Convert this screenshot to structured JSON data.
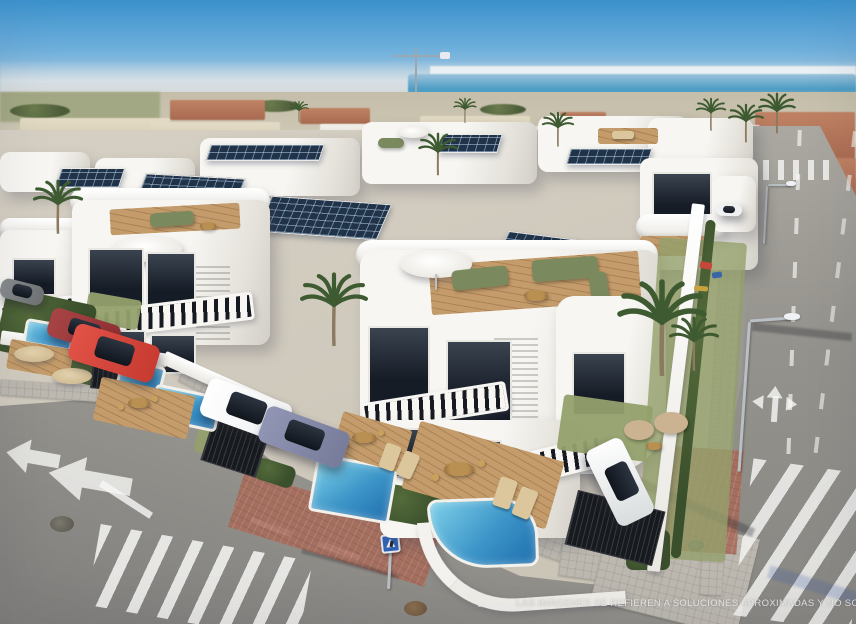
{
  "image": {
    "description": "Aerial 3D architectural render of a modern white villa development with private pools, rooftop terraces, solar panels, palm trees, parked cars and surrounding streets, with a lagoon and city skyline on the horizon",
    "watermark": "LAS IMÁGENES SE REFIEREN A SOLUCIONES APROXIMADAS Y NO SON VINCULANTES AL PR",
    "signs": {
      "pedestrian_crossing_sign": "blue square with white walking-person triangle"
    },
    "palette": {
      "sky_top": "#3d96d2",
      "sky_horizon": "#c9d8e2",
      "sea": "#4e9ec6",
      "villa_white": "#f7f6f2",
      "wall_white": "#e9e7e1",
      "solar_panel": "#203349",
      "pool_water": "#1f6fae",
      "deck_wood": "#c49c6b",
      "hedge_green": "#3a4f2b",
      "palm_green": "#3e5a31",
      "lawn_green": "#93a06b",
      "sidewalk": "#bcb8b0",
      "red_paving": "#a96a58",
      "sign_blue": "#2f63b8",
      "car_red": "#c63a30",
      "car_dark_red": "#8e2f31",
      "car_blue_grey": "#767b99",
      "car_white": "#eef0f1",
      "car_grey": "#6e7173"
    }
  }
}
